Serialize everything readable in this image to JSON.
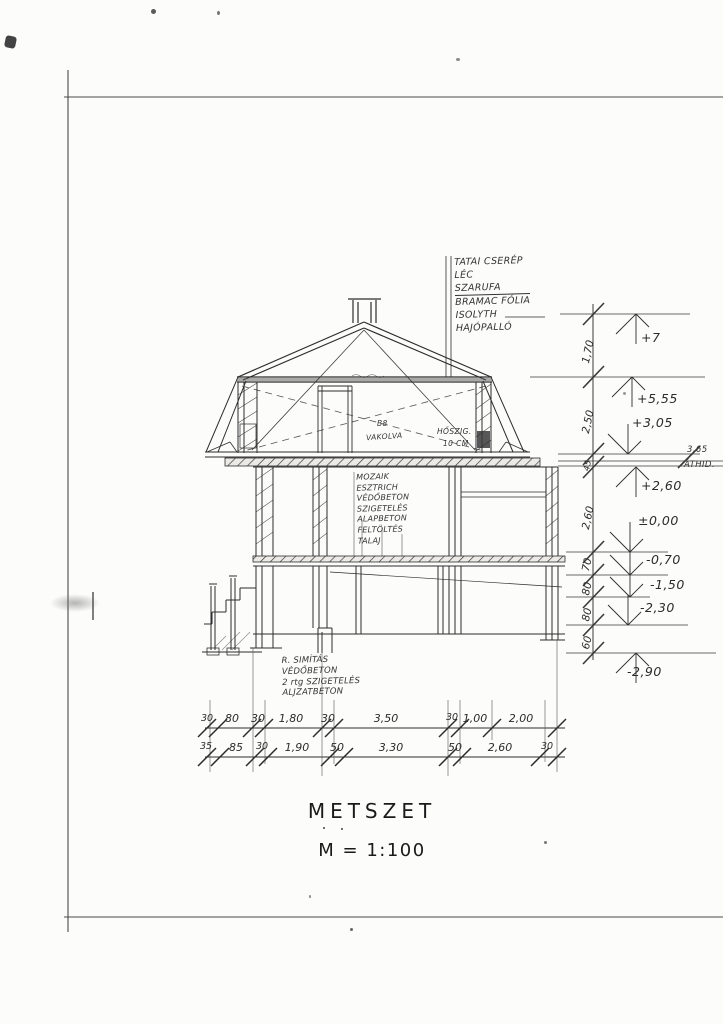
{
  "title": {
    "name": "METSZET",
    "scale": "M = 1:100"
  },
  "roof_layer_list": {
    "items": [
      "TATAI CSERÉP",
      "LÉC",
      "SZARUFA",
      "BRAMAC FÓLIA",
      "ISOLYTH",
      "HAJÓPALLÓ"
    ]
  },
  "attic_labels": {
    "left_ref": "B8",
    "left": "VAKOLVA",
    "right1": "HŐSZIG.",
    "right2": "10 CM"
  },
  "floor_layer_list": {
    "items": [
      "MOZAIK",
      "ESZTRICH",
      "VÉDŐBETON",
      "SZIGETELÉS",
      "ALAPBETON",
      "FELTÖLTÉS",
      "TALAJ"
    ]
  },
  "foundation_layer_list": {
    "items": [
      "R. SIMÍTÁS",
      "VÉDŐBETON",
      "2 rtg SZIGETELÉS",
      "ALJZATBETON"
    ]
  },
  "levels": {
    "items": [
      "+7",
      "+5,55",
      "+3,05",
      "+2,60",
      "±0,00",
      "-0,70",
      "-1,50",
      "-2,30",
      "-2,90"
    ]
  },
  "edge_note": {
    "value": "3,65",
    "label": "ÁTHID."
  },
  "vertical_dims": {
    "items": [
      "1,70",
      "2,50",
      "45",
      "2,60",
      "70",
      "80",
      "80",
      "60"
    ]
  },
  "dim_chains": {
    "upper": [
      "30",
      "80",
      "30",
      "1,80",
      "30",
      "3,50",
      "30",
      "1,00",
      "2,00"
    ],
    "lower": [
      "35",
      "85",
      "30",
      "1,90",
      "50",
      "3,30",
      "50",
      "2,60",
      "30"
    ]
  },
  "colors": {
    "ink": "#2d2d2d",
    "paper": "#fcfcfb"
  }
}
